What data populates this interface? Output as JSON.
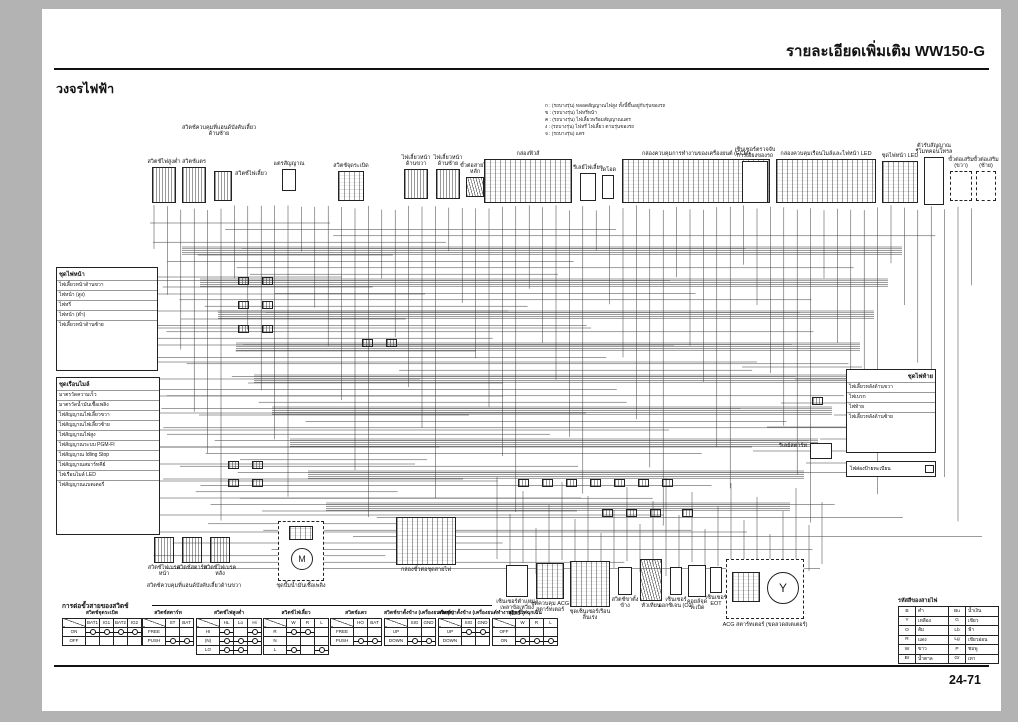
{
  "page": {
    "header": "รายละเอียดเพิ่มเติม WW150-G",
    "section_title": "วงจรไฟฟ้า",
    "page_number": "24-71"
  },
  "notes": {
    "lines": [
      "ก : (รถบางรุ่น) หลอดสัญญาณไฟสูง ทั้งนี้ขึ้นอยู่กับรุ่นของรถ",
      "ข : (รถบางรุ่น) ไฟหรี่หน้า",
      "ค : (รถบางรุ่น) ไฟเลี้ยวพร้อมสัญญาณแตร",
      "ง : (รถบางรุ่น) ไฟหรี่ ไฟเลี้ยว ตามรุ่นของรถ",
      "จ : (รถบางรุ่น) แตร"
    ]
  },
  "diagram": {
    "components": {
      "left_handle_note": {
        "label": "สวิตช์ควบคุมที่แฮนด์บังคับเลี้ยวด้านซ้าย"
      },
      "dimmer_switch": {
        "label": "สวิตช์ไฟสูงต่ำ"
      },
      "horn_switch": {
        "label": "สวิตช์แตร"
      },
      "turn_signal_switch": {
        "label": "สวิตช์ไฟเลี้ยว"
      },
      "horn": {
        "label": "แตรสัญญาณ"
      },
      "ignition_switch": {
        "label": "สวิตช์จุดระเบิด"
      },
      "front_turn_right": {
        "label": "ไฟเลี้ยวหน้าด้านขวา"
      },
      "front_turn_left": {
        "label": "ไฟเลี้ยวหน้าด้านซ้าย"
      },
      "harness_connector": {
        "label": "ขั้วต่อสายไฟหลัก"
      },
      "fuse_box": {
        "label": "กล่องฟิวส์"
      },
      "flasher_relay": {
        "label": "รีเลย์ไฟเลี้ยว"
      },
      "diode": {
        "label": "ไดโอด"
      },
      "ecm": {
        "label": "กล่องควบคุมการทำงานของเครื่องยนต์ (ECM)"
      },
      "bank_angle_sensor": {
        "label": "เซ็นเซอร์ตรวจจับการเอียงของรถ"
      },
      "meter_control_box": {
        "label": "กล่องควบคุมเรือนไมล์และไฟหน้า LED"
      },
      "headlight_led": {
        "label": "ชุดไฟหน้า LED"
      },
      "remote_receiver": {
        "label": "ตัวรับสัญญาณรีโมทคอนโทรล"
      },
      "option_connector_r": {
        "label": "ขั้วต่อเสริม (ขวา)"
      },
      "option_connector_l": {
        "label": "ขั้วต่อเสริม (ซ้าย)"
      },
      "headlight_unit": {
        "label": "ชุดไฟหน้า",
        "items": [
          "ไฟเลี้ยวหน้าด้านขวา",
          "ไฟหน้า (สูง)",
          "ไฟหรี่",
          "ไฟหน้า (ต่ำ)",
          "ไฟเลี้ยวหน้าด้านซ้าย"
        ]
      },
      "instrument_cluster": {
        "label": "ชุดเรือนไมล์",
        "items": [
          "มาตรวัดความเร็ว",
          "มาตรวัดน้ำมันเชื้อเพลิง",
          "ไฟสัญญาณไฟเลี้ยวขวา",
          "ไฟสัญญาณไฟเลี้ยวซ้าย",
          "ไฟสัญญาณไฟสูง",
          "ไฟสัญญาณระบบ PGM-FI",
          "ไฟสัญญาณ Idling Stop",
          "ไฟสัญญาณสมาร์ทคีย์",
          "ไฟเรือนไมล์ LED",
          "ไฟสัญญาณแบตเตอรี่"
        ]
      },
      "right_handle_group": {
        "label": "สวิตช์ควบคุมที่แฮนด์บังคับเลี้ยวด้านขวา",
        "items": [
          "สวิตช์ไฟเบรคหน้า",
          "สวิตช์สตาร์ท",
          "สวิตช์ไฟเบรคหลัง"
        ]
      },
      "fuel_pump": {
        "label": "ชุดปั๊มน้ำมันเชื้อเพลิง"
      },
      "harness_junction": {
        "label": "กล่องขั้วต่อชุดสายไฟ"
      },
      "ckp_sensor": {
        "label": "เซ็นเซอร์ตำแหน่งเพลาข้อเหวี่ยง (CKP)"
      },
      "acg_control": {
        "label": "ชุดควบคุม ACG สตาร์ทเตอร์"
      },
      "throttle_body": {
        "label": "ชุดเซ็นเซอร์เรือนลิ้นเร่ง"
      },
      "side_stand_switch": {
        "label": "สวิตช์ขาตั้งข้าง"
      },
      "spark_plug": {
        "label": "หัวเทียน"
      },
      "o2_sensor": {
        "label": "เซ็นเซอร์ออกซิเจน (O2)"
      },
      "ignition_coil": {
        "label": "คอยล์จุดระเบิด"
      },
      "eot_sensor": {
        "label": "เซ็นเซอร์ EOT"
      },
      "acg_starter": {
        "label": "ACG สตาร์ทเตอร์ (ขดลวดสเตเตอร์)"
      },
      "tail_unit": {
        "label": "ชุดไฟท้าย",
        "items": [
          "ไฟเลี้ยวหลังด้านขวา",
          "ไฟเบรก",
          "ไฟท้าย",
          "ไฟเลี้ยวหลังด้านซ้าย"
        ]
      },
      "license_light": {
        "label": "ไฟส่องป้ายทะเบียน"
      },
      "starter_relay": {
        "label": "รีเลย์สตาร์ท"
      }
    }
  },
  "switch_tables": {
    "title": "การต่อขั้วสายของสวิตช์",
    "tables": [
      {
        "title": "สวิตช์จุดระเบิด",
        "cols": [
          "BAT1",
          "IG1",
          "BAT2",
          "IG2"
        ],
        "rows": [
          {
            "label": "ON",
            "conn": [
              [
                0,
                1
              ],
              [
                2,
                3
              ]
            ]
          },
          {
            "label": "OFF",
            "conn": []
          }
        ]
      },
      {
        "title": "สวิตช์สตาร์ท",
        "cols": [
          "ST",
          "BAT"
        ],
        "rows": [
          {
            "label": "FREE",
            "conn": []
          },
          {
            "label": "PUSH",
            "conn": [
              [
                0,
                1
              ]
            ]
          }
        ]
      },
      {
        "title": "สวิตช์ไฟสูงต่ำ",
        "cols": [
          "HL",
          "Lo",
          "Hi"
        ],
        "rows": [
          {
            "label": "HI",
            "conn": [
              [
                0,
                2
              ]
            ]
          },
          {
            "label": "(N)",
            "conn": [
              [
                0,
                1,
                2
              ]
            ]
          },
          {
            "label": "LO",
            "conn": [
              [
                0,
                1
              ]
            ]
          }
        ]
      },
      {
        "title": "สวิตช์ไฟเลี้ยว",
        "cols": [
          "W",
          "R",
          "L"
        ],
        "rows": [
          {
            "label": "R",
            "conn": [
              [
                0,
                1
              ]
            ]
          },
          {
            "label": "N",
            "conn": []
          },
          {
            "label": "L",
            "conn": [
              [
                0,
                2
              ]
            ]
          }
        ]
      },
      {
        "title": "สวิตช์แตร",
        "cols": [
          "HO",
          "BAT"
        ],
        "rows": [
          {
            "label": "FREE",
            "conn": []
          },
          {
            "label": "PUSH",
            "conn": [
              [
                0,
                1
              ]
            ]
          }
        ]
      },
      {
        "title": "สวิตช์ขาตั้งข้าง (เครื่องยนต์หยุด)",
        "cols": [
          "SIG",
          "GND"
        ],
        "rows": [
          {
            "label": "UP",
            "conn": []
          },
          {
            "label": "DOWN",
            "conn": [
              [
                0,
                1
              ]
            ]
          }
        ]
      },
      {
        "title": "สวิตช์ขาตั้งข้าง (เครื่องยนต์ทำงาน)",
        "cols": [
          "SIG",
          "GND"
        ],
        "rows": [
          {
            "label": "UP",
            "conn": [
              [
                0,
                1
              ]
            ]
          },
          {
            "label": "DOWN",
            "conn": []
          }
        ]
      },
      {
        "title": "สวิตช์ไฟฉุกเฉิน",
        "cols": [
          "W",
          "R",
          "L"
        ],
        "rows": [
          {
            "label": "OFF",
            "conn": []
          },
          {
            "label": "ON",
            "conn": [
              [
                0,
                1,
                2
              ]
            ]
          }
        ]
      }
    ]
  },
  "color_codes": {
    "title": "รหัสสีของสายไฟ",
    "entries": [
      [
        "B",
        "ดำ"
      ],
      [
        "Y",
        "เหลือง"
      ],
      [
        "O",
        "ส้ม"
      ],
      [
        "R",
        "แดง"
      ],
      [
        "W",
        "ขาว"
      ],
      [
        "Br",
        "น้ำตาล"
      ],
      [
        "Bu",
        "น้ำเงิน"
      ],
      [
        "G",
        "เขียว"
      ],
      [
        "Lb",
        "ฟ้า"
      ],
      [
        "Lg",
        "เขียวอ่อน"
      ],
      [
        "P",
        "ชมพู"
      ],
      [
        "Gr",
        "เทา"
      ]
    ]
  },
  "theme": {
    "page_bg": "#ffffff",
    "frame_bg": "#b3b3b3",
    "ink": "#111111"
  }
}
